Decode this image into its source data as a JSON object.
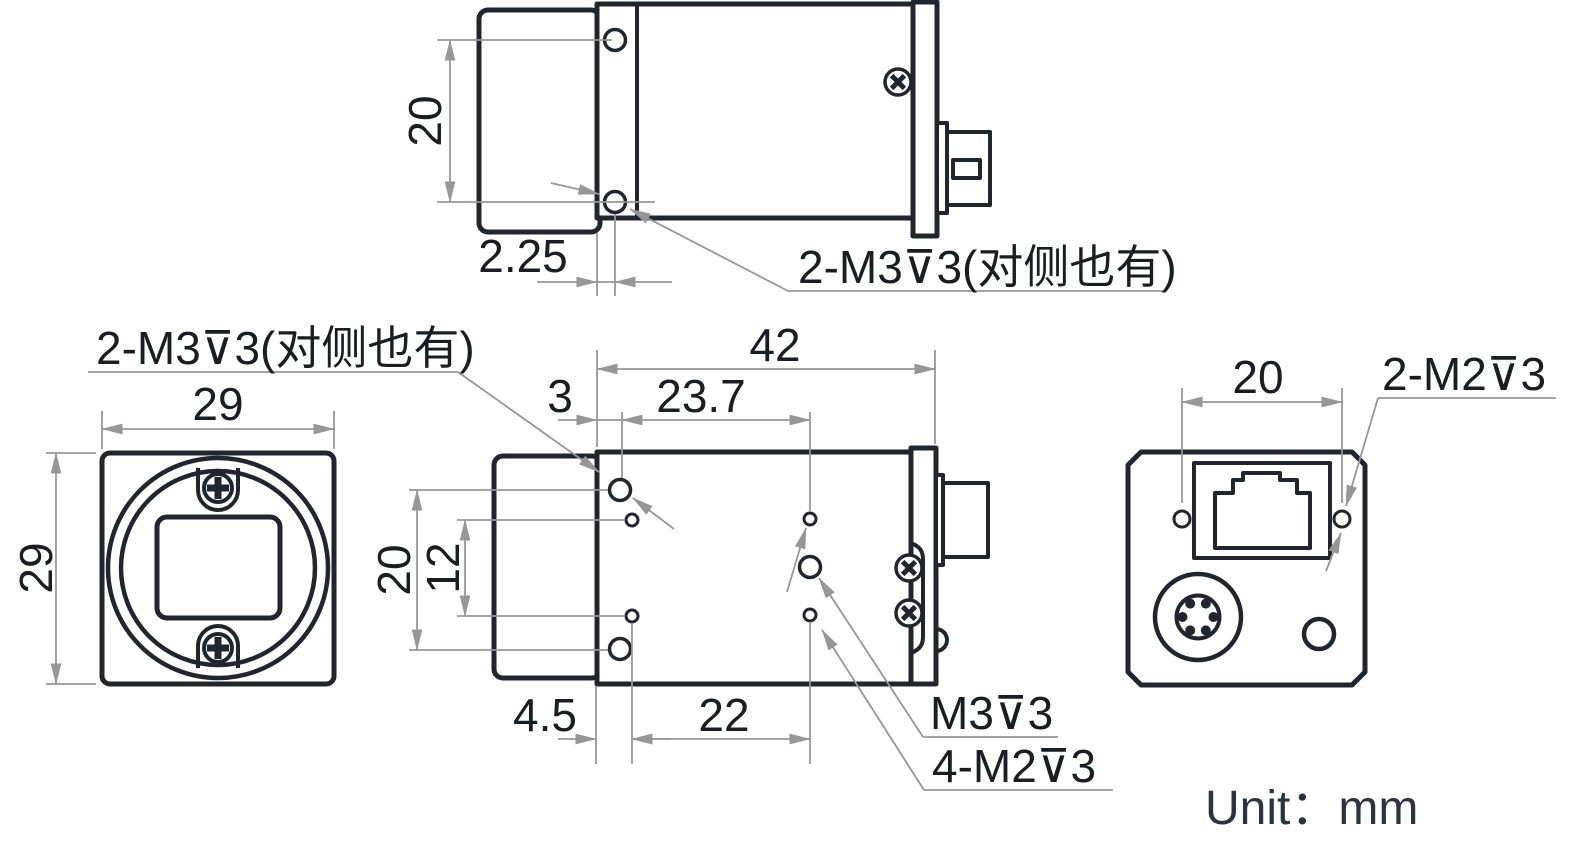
{
  "unit_note": "Unit：mm",
  "colors": {
    "outline": "#21262e",
    "dimension_line": "#979797",
    "dimension_text": "#1a1d21",
    "unit_text": "#2c333d",
    "background": "#ffffff"
  },
  "views": {
    "top": {
      "dim_hole_pitch": "20",
      "dim_hole_offset": "2.25",
      "thread_label": "2-M3⊽3(对侧也有)"
    },
    "front": {
      "dim_width": "29",
      "dim_height": "29"
    },
    "side": {
      "thread_label": "2-M3⊽3(对侧也有)",
      "dim_length": "42",
      "dim_front_offset": "3",
      "dim_m3_span": "23.7",
      "dim_m3_pitch": "20",
      "dim_m2_pitch": "12",
      "dim_m2_offset": "4.5",
      "dim_m2_span": "22",
      "m3_depth_label": "M3⊽3",
      "m2_depth_label": "4-M2⊽3"
    },
    "back": {
      "dim_pitch": "20",
      "thread_label": "2-M2⊽3"
    }
  }
}
